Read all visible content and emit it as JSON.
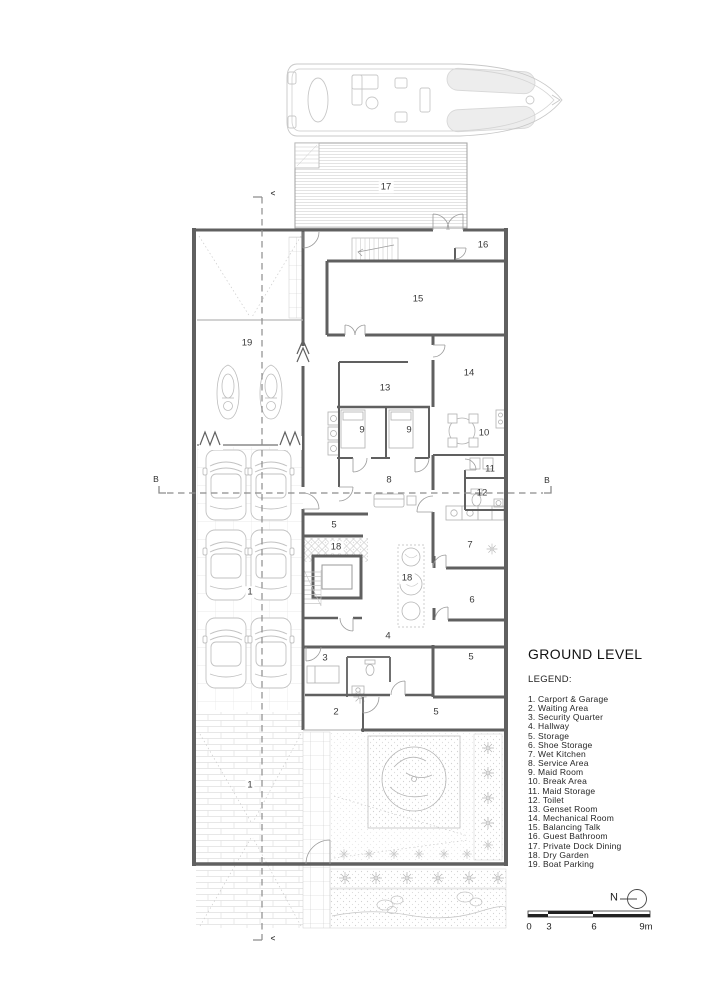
{
  "drawing": {
    "title": "GROUND LEVEL",
    "legend_label": "LEGEND:",
    "legend_items": [
      "1. Carport & Garage",
      "2. Waiting Area",
      "3. Security Quarter",
      "4. Hallway",
      "5. Storage",
      "6. Shoe Storage",
      "7. Wet Kitchen",
      "8. Service Area",
      "9. Maid Room",
      "10. Break Area",
      "11. Maid Storage",
      "12. Toilet",
      "13. Genset Room",
      "14. Mechanical Room",
      "15. Balancing Talk",
      "16. Guest Bathroom",
      "17. Private Dock Dining",
      "18. Dry Garden",
      "19. Boat Parking"
    ],
    "room_labels": [
      {
        "text": "17",
        "x": 386,
        "y": 187,
        "bg": true
      },
      {
        "text": "16",
        "x": 483,
        "y": 245
      },
      {
        "text": "15",
        "x": 418,
        "y": 299
      },
      {
        "text": "19",
        "x": 247,
        "y": 343
      },
      {
        "text": "13",
        "x": 385,
        "y": 388
      },
      {
        "text": "14",
        "x": 469,
        "y": 373
      },
      {
        "text": "9",
        "x": 362,
        "y": 430
      },
      {
        "text": "9",
        "x": 409,
        "y": 430
      },
      {
        "text": "10",
        "x": 484,
        "y": 433
      },
      {
        "text": "11",
        "x": 490,
        "y": 469
      },
      {
        "text": "8",
        "x": 389,
        "y": 480
      },
      {
        "text": "12",
        "x": 482,
        "y": 493
      },
      {
        "text": "5",
        "x": 334,
        "y": 525
      },
      {
        "text": "18",
        "x": 336,
        "y": 547,
        "bg": true
      },
      {
        "text": "7",
        "x": 470,
        "y": 545
      },
      {
        "text": "18",
        "x": 407,
        "y": 578,
        "bg": true
      },
      {
        "text": "6",
        "x": 472,
        "y": 600
      },
      {
        "text": "1",
        "x": 250,
        "y": 592,
        "bg": true
      },
      {
        "text": "4",
        "x": 388,
        "y": 636
      },
      {
        "text": "3",
        "x": 325,
        "y": 658
      },
      {
        "text": "5",
        "x": 471,
        "y": 657
      },
      {
        "text": "2",
        "x": 336,
        "y": 712
      },
      {
        "text": "5",
        "x": 436,
        "y": 712
      },
      {
        "text": "1",
        "x": 250,
        "y": 785,
        "bg": true
      }
    ],
    "annotations": [
      {
        "name": "section-label-b-left",
        "text": "B",
        "x": 156,
        "y": 479,
        "cls": "sm"
      },
      {
        "name": "section-label-b-right",
        "text": "B",
        "x": 547,
        "y": 480,
        "cls": "sm"
      },
      {
        "name": "section-arrow-top",
        "text": "<",
        "x": 273,
        "y": 194,
        "cls": "arrow"
      },
      {
        "name": "section-arrow-bottom",
        "text": "<",
        "x": 273,
        "y": 939,
        "cls": "arrow"
      },
      {
        "name": "scale-tick-0",
        "text": "0",
        "x": 529,
        "y": 927,
        "cls": "scale"
      },
      {
        "name": "scale-tick-3",
        "text": "3",
        "x": 549,
        "y": 927,
        "cls": "scale"
      },
      {
        "name": "scale-tick-6",
        "text": "6",
        "x": 594,
        "y": 927,
        "cls": "scale"
      },
      {
        "name": "scale-tick-9m",
        "text": "9m",
        "x": 646,
        "y": 927,
        "cls": "scale"
      },
      {
        "name": "north-label",
        "text": "N",
        "x": 614,
        "y": 898,
        "cls": "north"
      }
    ],
    "colors": {
      "wall": "#606060",
      "thin_line": "#9a9a9a",
      "furniture": "#bdbdbd",
      "pattern": "#dcdcdc",
      "text": "#3a3a3a"
    }
  }
}
